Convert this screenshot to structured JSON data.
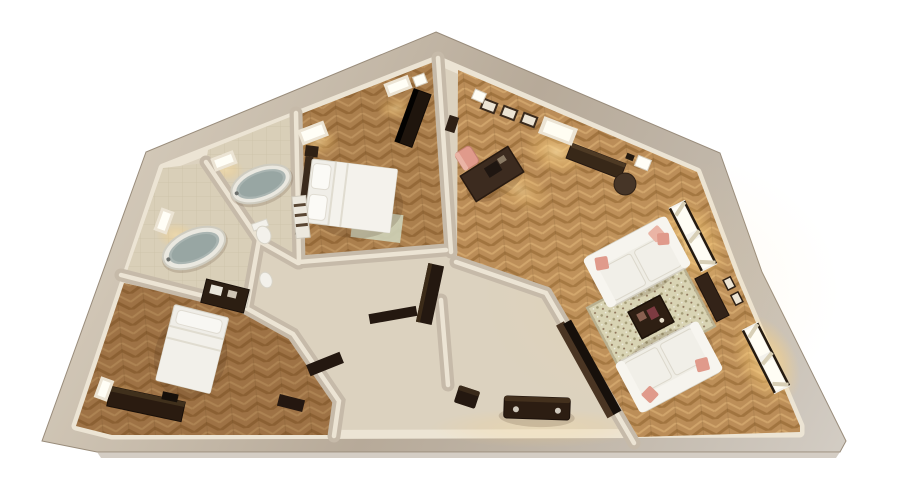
{
  "meta": {
    "title": "3D apartment floor plan render",
    "canvas": {
      "width": 900,
      "height": 500
    }
  },
  "scene": {
    "description": "Top-down 3D architectural render of a furnished apartment: living room with two white sofas and patterned rug on herringbone parquet, upper bedroom with double bed, two bathrooms with oval bathtubs, lower-left bedroom with double bed, and a central hallway with dark wood doors; beige walls on a white background",
    "rooms": [
      {
        "name": "living-room",
        "floor": "herringbone-parquet",
        "items": [
          "sofa-upper",
          "sofa-lower",
          "area-rug",
          "coffee-table",
          "writing-desk",
          "desk-chair",
          "sideboard",
          "round-pouf",
          "media-panel",
          "entry-chest",
          "entry-stool",
          "window-wall-east",
          "window-top",
          "wall-frames"
        ]
      },
      {
        "name": "bedroom-upper",
        "floor": "herringbone-parquet",
        "items": [
          "double-bed",
          "headboard",
          "nightstands",
          "foot-rug",
          "wardrobe",
          "windows"
        ]
      },
      {
        "name": "bathroom-upper",
        "floor": "stone-tile",
        "items": [
          "oval-bathtub",
          "toilet",
          "towel-shelf",
          "window"
        ]
      },
      {
        "name": "bathroom-left",
        "floor": "stone-tile",
        "items": [
          "oval-bathtub",
          "toilet",
          "vanity",
          "window"
        ]
      },
      {
        "name": "bedroom-lower",
        "floor": "herringbone-parquet",
        "items": [
          "double-bed",
          "dresser",
          "low-chest",
          "windows"
        ]
      },
      {
        "name": "hallway-entry",
        "floor": "stone-tile",
        "items": [
          "door-panels",
          "bench"
        ]
      }
    ],
    "window_count": 10
  },
  "palette": {
    "bg": "#ffffff",
    "wall-top": "#b7aa99",
    "wall-light": "#d6ccbc",
    "wall-dark": "#a3968476",
    "wall-lit": "#ece4d4",
    "wall-inner": "#c6baa9",
    "floor-hall": "#dcd2bf",
    "wood-base": "#bb8d58",
    "wood-dark": "#a1743f",
    "wood-light": "#d0a46b",
    "tile": "#d9cfb8",
    "tile-line": "#c2b69c",
    "rug-base": "#d8d3b3",
    "rug-dot1": "#a59d78",
    "rug-dot2": "#8c7258",
    "sofa": "#efede5",
    "sofa-line": "#d6d2c6",
    "dark-wood": "#2e1f13",
    "dark-wood2": "#4a3523",
    "door": "#241810",
    "pink": "#e09a8b",
    "pink2": "#eab4a5",
    "tub": "#eae8e0",
    "water": "#98a6a3",
    "water-rim": "#aab5b2",
    "white-goods": "#f3f1eb",
    "glow": "#ffe2a3",
    "glow2": "#ffd27d",
    "shadow": "rgba(60,40,20,0.16)"
  }
}
